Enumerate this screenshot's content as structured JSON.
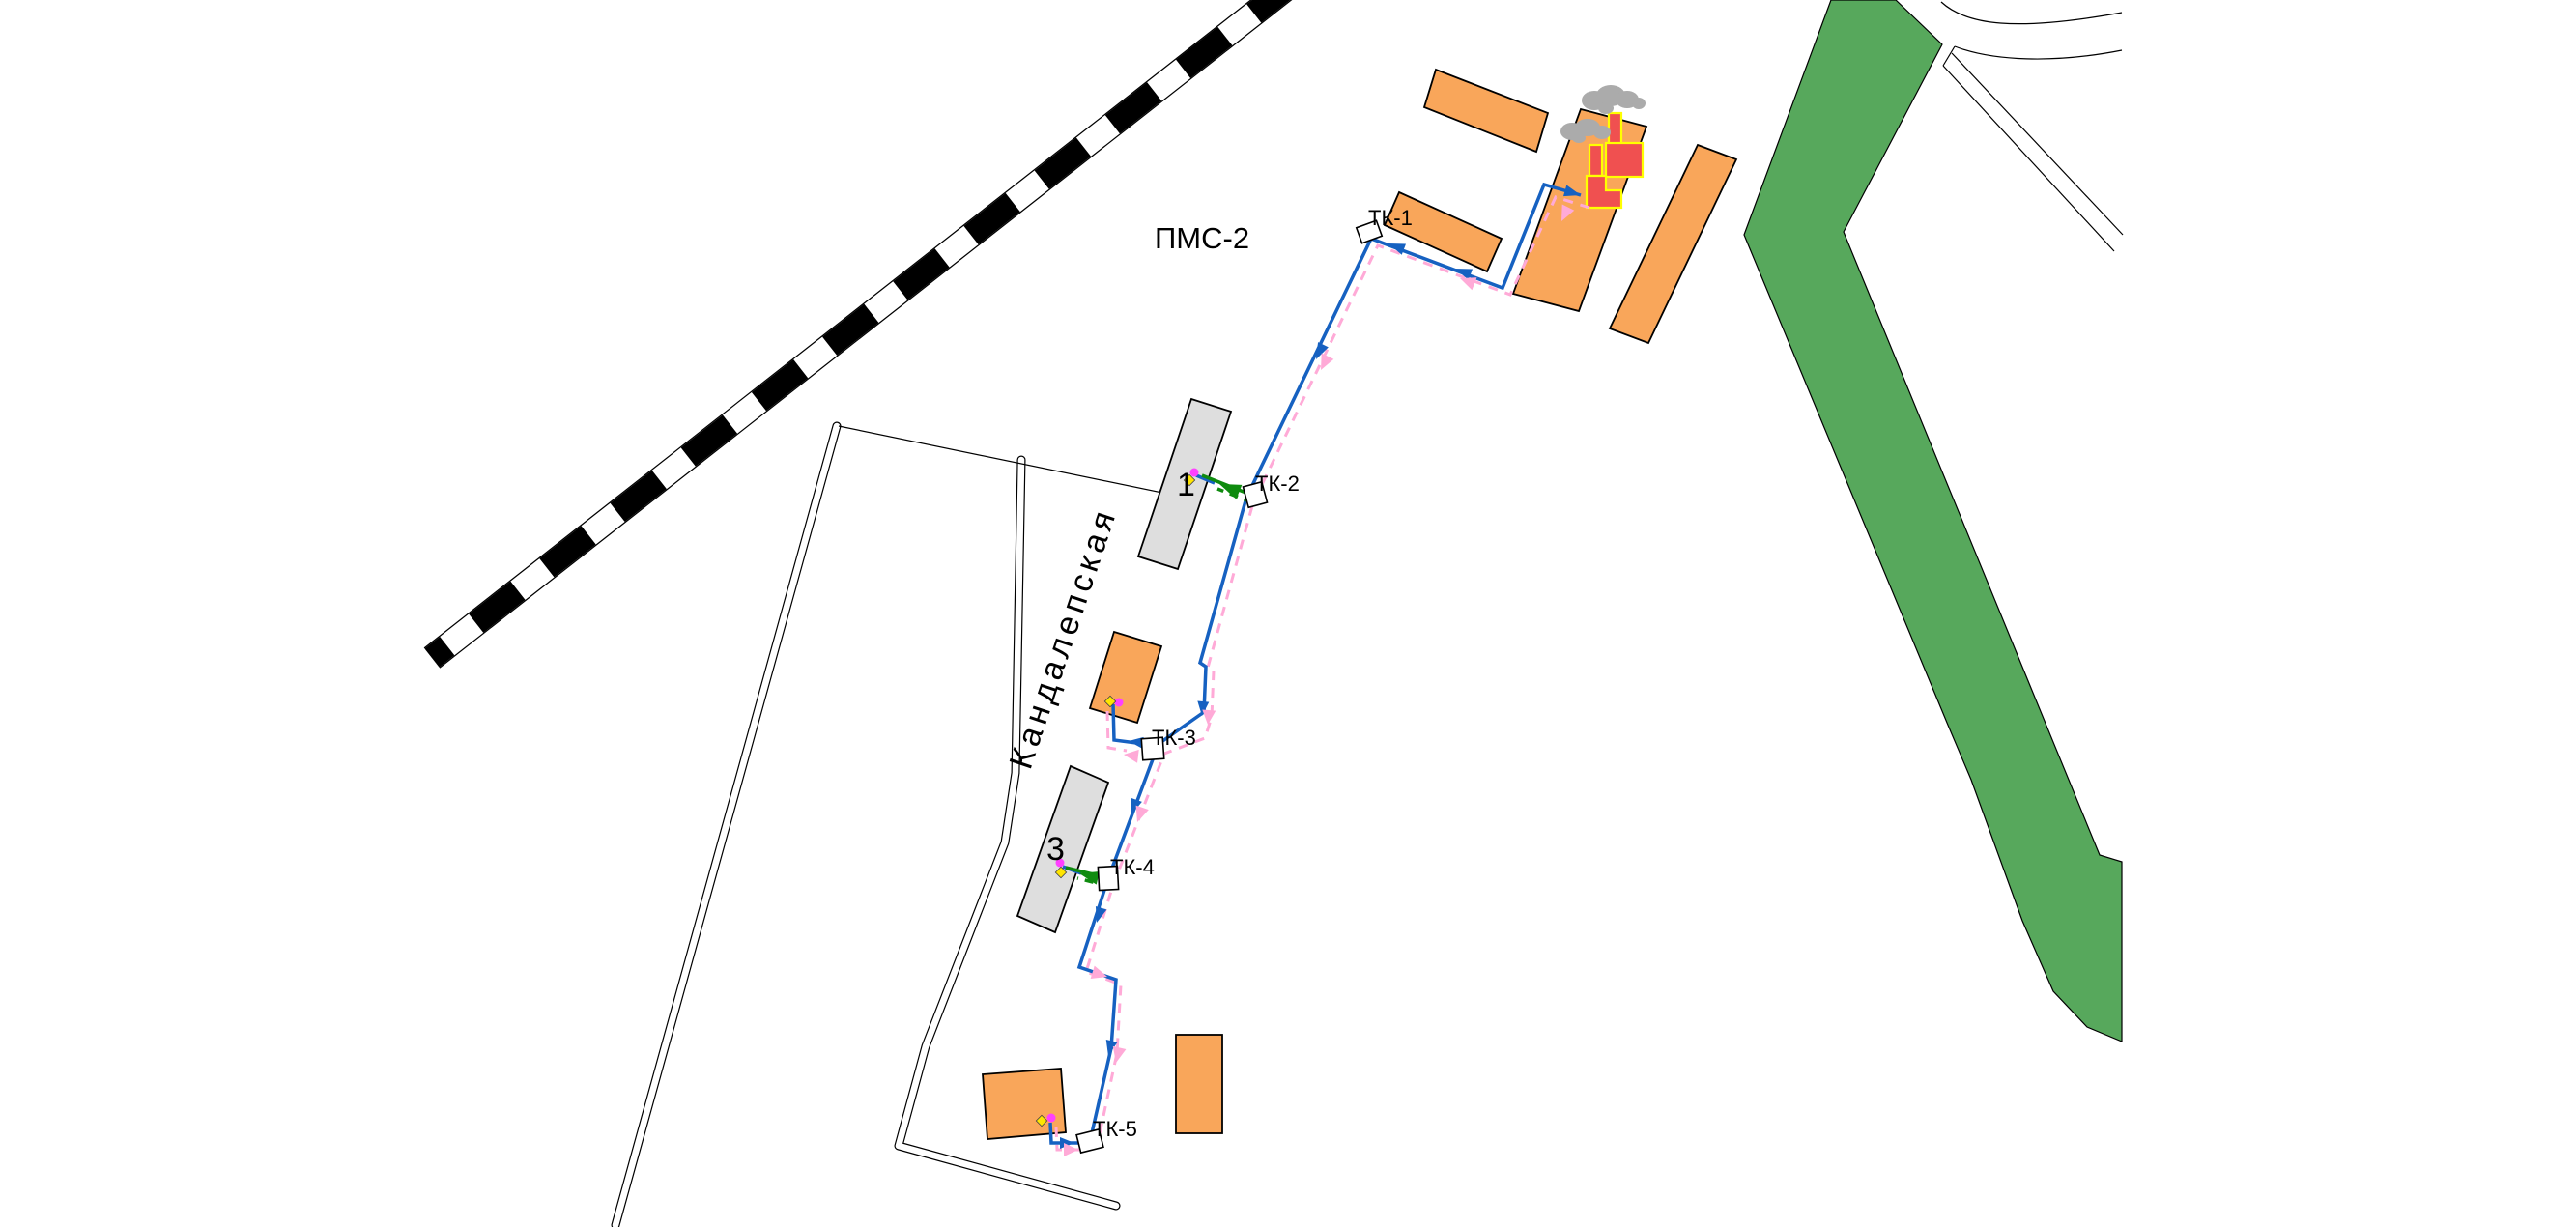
{
  "map": {
    "region_label": "ПМС-2",
    "street_label": "Кандалепская",
    "nodes": [
      {
        "label": "ТК-1"
      },
      {
        "label": "ТК-2"
      },
      {
        "label": "ТК-3"
      },
      {
        "label": "ТК-4"
      },
      {
        "label": "ТК-5"
      }
    ],
    "building_labels": {
      "b1": "1",
      "b3": "3"
    },
    "colors": {
      "background": "#FFFFFF",
      "building_fill": "#F9A65A",
      "public_building_fill": "#DEDEDE",
      "boiler_fill": "#F05050",
      "boiler_outline": "#FFFF00",
      "green_area": "#57A85C",
      "supply_line": "#1661C1",
      "return_line": "#FFAAD7",
      "service_line": "#0F8B0F",
      "smoke": "#ABABAB",
      "connection_magenta": "#FF40FF",
      "connection_yellow": "#FFE500",
      "railway": "#000000"
    }
  }
}
